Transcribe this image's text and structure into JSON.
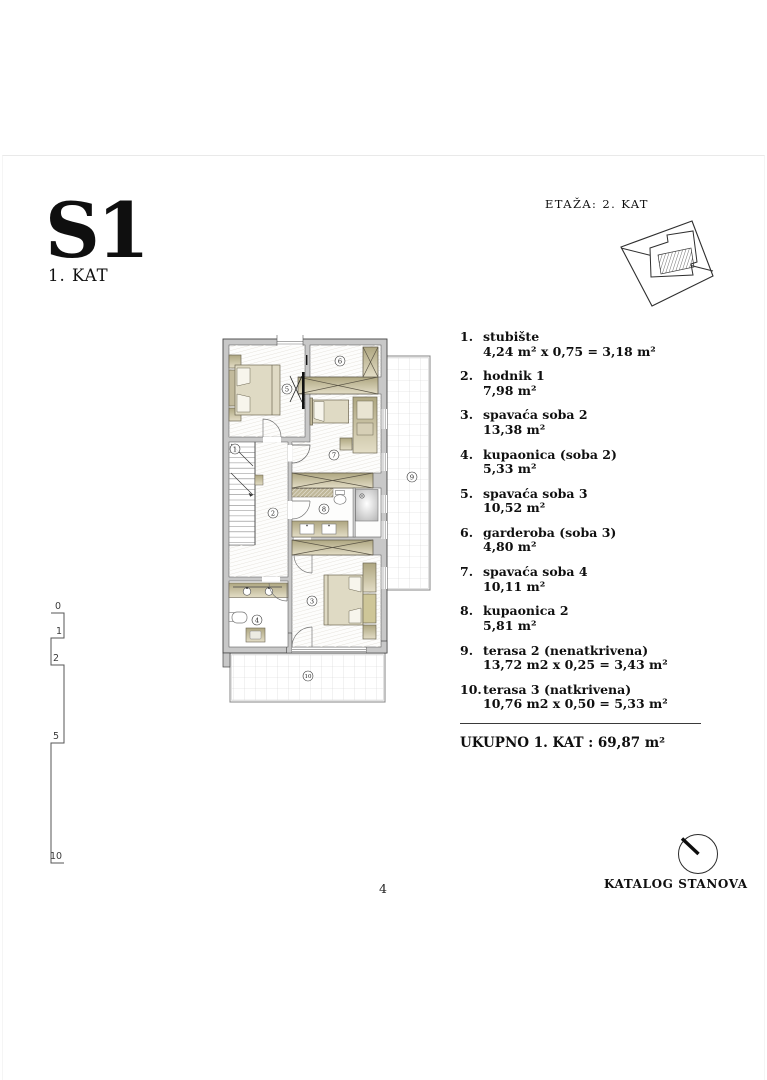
{
  "header": {
    "unit_code": "S1",
    "floor_label": "1. KAT",
    "etaza_label": "ETAŽA: 2. KAT"
  },
  "legend": {
    "items": [
      {
        "num": "1.",
        "name": "stubište",
        "area": "4,24 m² x 0,75 = 3,18 m²"
      },
      {
        "num": "2.",
        "name": "hodnik 1",
        "area": "7,98 m²"
      },
      {
        "num": "3.",
        "name": "spavaća soba 2",
        "area": "13,38 m²"
      },
      {
        "num": "4.",
        "name": "kupaonica (soba 2)",
        "area": "5,33 m²"
      },
      {
        "num": "5.",
        "name": "spavaća soba 3",
        "area": "10,52 m²"
      },
      {
        "num": "6.",
        "name": "garderoba (soba 3)",
        "area": "4,80 m²"
      },
      {
        "num": "7.",
        "name": "spavaća soba 4",
        "area": "10,11 m²"
      },
      {
        "num": "8.",
        "name": "kupaonica 2",
        "area": "5,81 m²"
      },
      {
        "num": "9.",
        "name": "terasa 2 (nenatkrivena)",
        "area": "13,72 m2 x 0,25 = 3,43 m²"
      },
      {
        "num": "10.",
        "name": "terasa 3 (natkrivena)",
        "area": "10,76 m2 x 0,50 = 5,33 m²"
      }
    ],
    "total": "UKUPNO 1. KAT : 69,87 m²"
  },
  "floorplan": {
    "room_numbers": [
      "1",
      "2",
      "3",
      "4",
      "5",
      "6",
      "7",
      "8",
      "9",
      "10"
    ],
    "scale_ticks": [
      "0",
      "1",
      "2",
      "5",
      "10"
    ]
  },
  "footer": {
    "page_number": "4",
    "catalog_label": "KATALOG STANOVA"
  },
  "colors": {
    "wall": "#c8c8c8",
    "wall_edge": "#454545",
    "furniture_tan": "#b9b194",
    "mattress": "#dfdac4",
    "floor_hatch": "#e2dfd7",
    "terrace_grid": "#d4d4d4",
    "text": "#0f0f0f"
  }
}
